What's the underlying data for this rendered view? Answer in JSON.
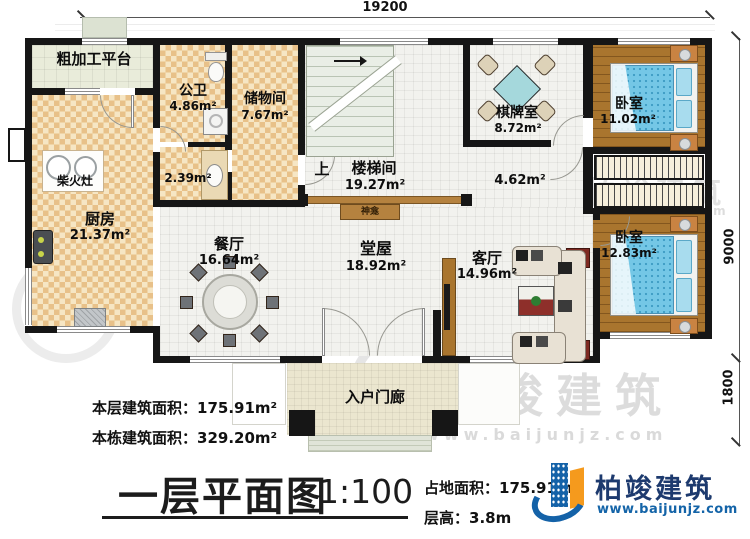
{
  "dims": {
    "top": "19200",
    "right_main": "9000",
    "right_porch": "1800"
  },
  "rooms": {
    "rough_platform": {
      "name": "粗加工平台"
    },
    "public_bath": {
      "name": "公卫",
      "area": "4.86m²"
    },
    "storage": {
      "name": "储物间",
      "area": "7.67m²"
    },
    "stairwell": {
      "name": "楼梯间",
      "area": "19.27m²",
      "up": "上"
    },
    "chess": {
      "name": "棋牌室",
      "area": "8.72m²"
    },
    "bedroom1": {
      "name": "卧室",
      "area": "11.02m²"
    },
    "firewood_stove": {
      "name": "柴火灶"
    },
    "kitchen": {
      "name": "厨房",
      "area": "21.37m²"
    },
    "wash": {
      "area": "2.39m²"
    },
    "corner_hall": {
      "area": "4.62m²"
    },
    "dining": {
      "name": "餐厅",
      "area": "16.64m²"
    },
    "main_hall": {
      "name": "堂屋",
      "area": "18.92m²"
    },
    "living": {
      "name": "客厅",
      "area": "14.96m²"
    },
    "bedroom2": {
      "name": "卧室",
      "area": "12.83m²"
    },
    "shrine": {
      "name": "神龛"
    },
    "porch": {
      "name": "入户门廊"
    }
  },
  "stats": {
    "floor_area_label": "本层建筑面积：",
    "floor_area_value": "175.91m²",
    "building_area_label": "本栋建筑面积：",
    "building_area_value": "329.20m²"
  },
  "title_block": {
    "title": "一层平面图",
    "scale": "1:100",
    "land_area_label": "占地面积：",
    "land_area_value": "175.91m²",
    "height_label": "层高：",
    "height_value": "3.8m"
  },
  "brand": {
    "name": "柏竣建筑",
    "url": "www.baijunjz.com"
  },
  "watermark": {
    "text": "柏竣建筑",
    "url": "www.baijunjz.com"
  },
  "colors": {
    "wall": "#161616",
    "wood_floor": "#a9752e",
    "bed": "#74c7e6",
    "logo_blue": "#1462a8",
    "logo_orange": "#f59a1d"
  }
}
